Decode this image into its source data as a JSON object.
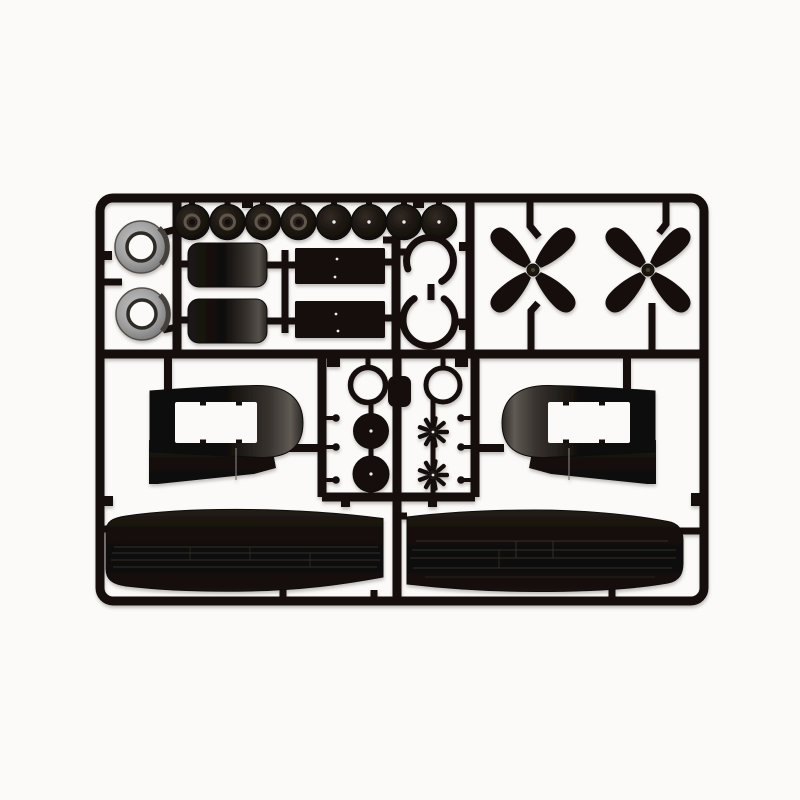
{
  "scene": {
    "subject": "Injection-molded black plastic model kit sprue (parts runner) with aircraft parts, photographed on a white background",
    "background_color": "#fbfaf8",
    "plastic_color": "#16110d",
    "panel_line_color": "#352e26",
    "white_dot_color": "#edebe7",
    "cowling_gray": "#9c9c9c",
    "hub_ring_gray": "#60564c",
    "shadow_color": "#6b655e"
  },
  "parts_inventory": [
    {
      "name": "wheel with hub ring",
      "count": 4
    },
    {
      "name": "wheel with center pip",
      "count": 4
    },
    {
      "name": "gray engine cowling ring",
      "count": 2
    },
    {
      "name": "engine cylinder drum",
      "count": 2
    },
    {
      "name": "rectangular panel",
      "count": 2
    },
    {
      "name": "open C-shaped cowl ring",
      "count": 2
    },
    {
      "name": "four-blade propeller",
      "count": 2
    },
    {
      "name": "hub ring",
      "count": 2
    },
    {
      "name": "wheel disc",
      "count": 2
    },
    {
      "name": "radial engine face",
      "count": 2
    },
    {
      "name": "engine nacelle half with opening",
      "count": 2
    },
    {
      "name": "lower wing half",
      "count": 2
    },
    {
      "name": "small locating pin",
      "count": 6
    }
  ]
}
